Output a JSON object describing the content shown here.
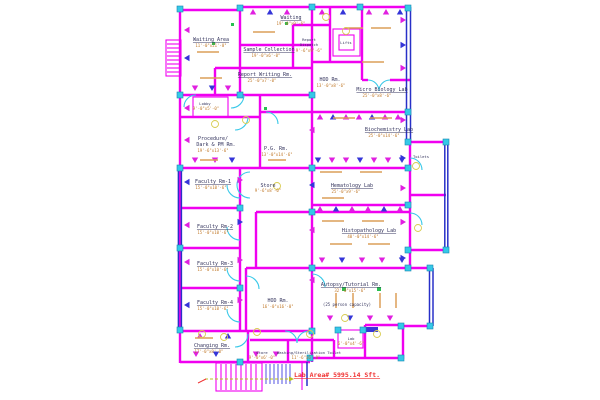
{
  "drawing": "pathology-lab-floor-plan",
  "rooms": {
    "waiting_area": {
      "name": "Waiting Area",
      "dim": "11'-0\"x21'-0\""
    },
    "waiting": {
      "name": "Waiting",
      "dim": "19'-0\"x9'-6\""
    },
    "sample_collection": {
      "name": "Sample Collection",
      "dim": "19'-0\"x6'-0\""
    },
    "report_writing": {
      "name": "Report Writing Rm.",
      "dim": "25'-0\"x7'-0\""
    },
    "report_dispatch": {
      "line1": "Report",
      "line2": "Dispatch",
      "dim": "9'-6\"x9'-6\""
    },
    "lifts": {
      "name": "Lifts"
    },
    "hod_top": {
      "name": "HOD Rm.",
      "dim": "13'-0\"x8'-6\""
    },
    "micro_biology": {
      "name": "Micro Biology Lab",
      "dim": "25'-0\"x8'-6\""
    },
    "lobby": {
      "name": "Lobby",
      "dim": "9'-0\"x5'-0\""
    },
    "procedure": {
      "line1": "Procedure/",
      "line2": "Dark & PM Rm.",
      "dim": "19'-6\"x13'-6\""
    },
    "pg_rm": {
      "name": "P.G. Rm.",
      "dim": "13'-0\"x14'-6\""
    },
    "biochemistry": {
      "name": "Biochemistry Lab",
      "dim": "25'-0\"x14'-6\""
    },
    "toilets": {
      "name": "Toilets"
    },
    "faculty_1": {
      "name": "Faculty Rm-1",
      "dim": "15'-0\"x10'-6\""
    },
    "faculty_2": {
      "name": "Faculty Rm-2",
      "dim": "15'-0\"x10'-6\""
    },
    "store_mid": {
      "name": "Store",
      "dim": "9'-6\"x8'-0\""
    },
    "hematology": {
      "name": "Hematology Lab",
      "dim": "25'-0\"x9'-6\""
    },
    "histopathology": {
      "name": "Histopathology Lab",
      "dim": "40'-0\"x14'-6\""
    },
    "faculty_3": {
      "name": "Faculty Rm-3",
      "dim": "15'-0\"x10'-6\""
    },
    "faculty_4": {
      "name": "Faculty Rm-4",
      "dim": "15'-0\"x10'-6\""
    },
    "hod_bottom": {
      "name": "HOD Rm.",
      "dim": "16'-0\"x16'-0\""
    },
    "autopsy": {
      "name": "Autopsy/Tutorial Rm.",
      "dim": "32'-0\"x15'-6\"",
      "capacity": "(25 person capacity)"
    },
    "changing": {
      "name": "Changing Rm.",
      "dim": "17'-0\"x8'-0\""
    },
    "store_bottom": {
      "name": "Store",
      "dim": "9'-0\"x6'-0\""
    },
    "washing": {
      "name": "Washing/Sterilization Toilet",
      "dim": "11'-6\"x6'-0\""
    },
    "lab_small": {
      "name": "Lab",
      "dim": "6'-0\"x4'-6\""
    }
  },
  "annotations": {
    "area_note": "Lab Area# 5995.14 Sft."
  },
  "palette": {
    "wall_magenta": "#f000f0",
    "wall_blue": "#2830c8",
    "door_cyan": "#38c8e8",
    "column_cyan": "#35c8e8",
    "furniture_orange": "#dc9f58",
    "dim_text_orange": "#c07828",
    "label_text": "#33335c",
    "area_note_red": "#f03030",
    "fixture_yellow": "#d8cc50",
    "dot_green": "#28c050"
  }
}
